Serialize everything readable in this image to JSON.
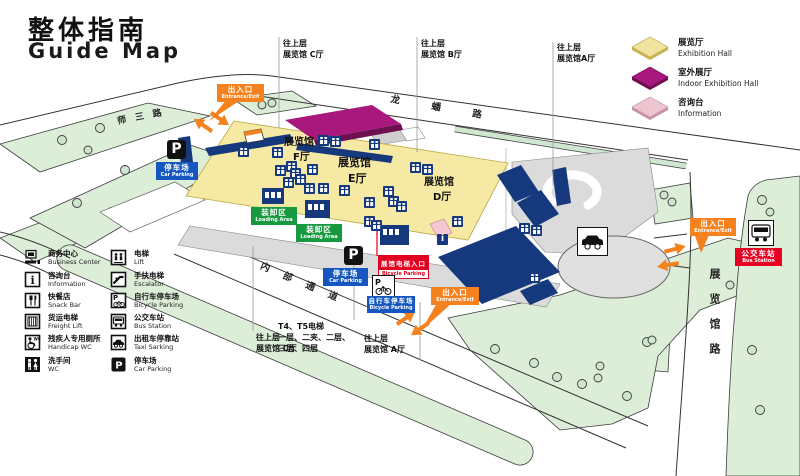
{
  "title": {
    "zh": "整体指南",
    "en": "Guide Map"
  },
  "top_legend": {
    "items": [
      {
        "zh": "展览厅",
        "en": "Exhibition Hall",
        "color": "#f1e3a0"
      },
      {
        "zh": "室外展厅",
        "en": "Indoor Exhibition Hall",
        "color": "#a9187d"
      },
      {
        "zh": "咨询台",
        "en": "Information",
        "color": "#ecc5d0"
      }
    ]
  },
  "roads": {
    "shisanlu": "师三路",
    "longpanlu": "龙蟠路",
    "neibutongdao": "内部通道",
    "zhanlanguanlu": "展览馆路"
  },
  "halls": {
    "f": [
      "展览馆",
      "F厅"
    ],
    "e": [
      "展览馆",
      "E厅"
    ],
    "d": [
      "展览馆",
      "D厅"
    ]
  },
  "upper_labels": {
    "c_top": [
      "往上层",
      "展览馆 C厅"
    ],
    "b_top": [
      "往上层",
      "展览馆 B厅"
    ],
    "a_top": [
      "往上层",
      "展览馆A厅"
    ],
    "c_bottom": [
      "往上层",
      "展览馆 C厅"
    ],
    "a_bottom": [
      "往上层",
      "展览馆 A厅"
    ]
  },
  "elevator_note": [
    "T4、T5电梯",
    "一层、二夹、二层、",
    "三层、四层"
  ],
  "signs": {
    "entrance": {
      "zh": "出入口",
      "en": "Entrance/Exit"
    },
    "car_parking": {
      "zh": "停车场",
      "en": "Car Parking"
    },
    "loading": {
      "zh": "装卸区",
      "en": "Loading Area"
    },
    "bicycle": {
      "zh": "自行车停车场",
      "en": "Bicycle Parking"
    },
    "hall_elevator": {
      "zh": "展馆电梯入口",
      "en": "Bicycle Parking"
    },
    "bus_station": {
      "zh": "公交车站",
      "en": "Bus Station"
    },
    "p_letter": "P"
  },
  "facility_legend": {
    "left": [
      {
        "icon": "business-center",
        "zh": "商务中心",
        "en": "Business Center"
      },
      {
        "icon": "information",
        "zh": "咨询台",
        "en": "Information"
      },
      {
        "icon": "snack-bar",
        "zh": "快餐店",
        "en": "Snack Bar"
      },
      {
        "icon": "freight-lift",
        "zh": "货运电梯",
        "en": "Freight Lift"
      },
      {
        "icon": "handicap-wc",
        "zh": "残疾人专用厕所",
        "en": "Handicap WC"
      },
      {
        "icon": "wc",
        "zh": "洗手间",
        "en": "WC"
      }
    ],
    "right": [
      {
        "icon": "lift",
        "zh": "电梯",
        "en": "Lift"
      },
      {
        "icon": "escalator",
        "zh": "手扶电梯",
        "en": "Escalator"
      },
      {
        "icon": "bicycle-parking",
        "zh": "自行车停车场",
        "en": "Bicycle Parking"
      },
      {
        "icon": "bus",
        "zh": "公交车站",
        "en": "Bus Station"
      },
      {
        "icon": "taxi",
        "zh": "出租车停靠站",
        "en": "Taxi Sarking"
      },
      {
        "icon": "car-parking",
        "zh": "停车场",
        "en": "Car Parking"
      }
    ]
  },
  "map_markers": [
    {
      "x": 238,
      "y": 146
    },
    {
      "x": 272,
      "y": 147
    },
    {
      "x": 318,
      "y": 135
    },
    {
      "x": 330,
      "y": 136
    },
    {
      "x": 369,
      "y": 139
    },
    {
      "x": 410,
      "y": 162
    },
    {
      "x": 422,
      "y": 164
    },
    {
      "x": 286,
      "y": 161
    },
    {
      "x": 275,
      "y": 165
    },
    {
      "x": 290,
      "y": 168
    },
    {
      "x": 307,
      "y": 164
    },
    {
      "x": 295,
      "y": 174
    },
    {
      "x": 283,
      "y": 177
    },
    {
      "x": 304,
      "y": 183
    },
    {
      "x": 318,
      "y": 183
    },
    {
      "x": 339,
      "y": 185
    },
    {
      "x": 383,
      "y": 186
    },
    {
      "x": 388,
      "y": 196
    },
    {
      "x": 396,
      "y": 201
    },
    {
      "x": 364,
      "y": 197
    },
    {
      "x": 364,
      "y": 216
    },
    {
      "x": 371,
      "y": 220
    },
    {
      "x": 452,
      "y": 216
    },
    {
      "x": 519,
      "y": 223
    },
    {
      "x": 531,
      "y": 225
    },
    {
      "x": 529,
      "y": 272
    },
    {
      "x": 437,
      "y": 234,
      "t": "i"
    }
  ]
}
